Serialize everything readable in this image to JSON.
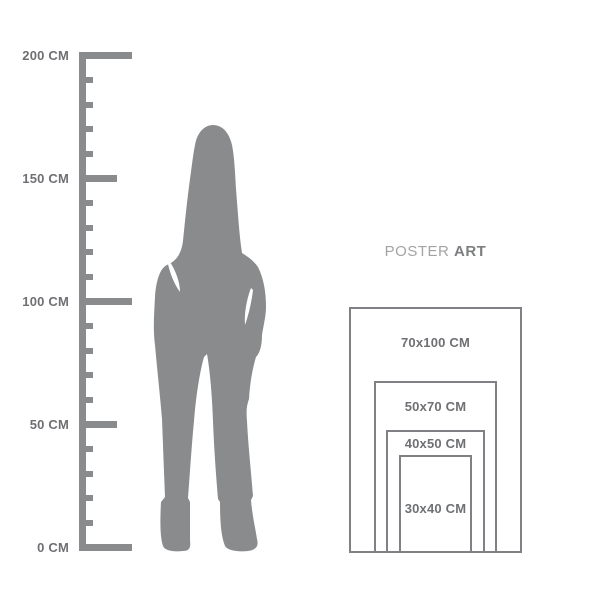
{
  "page": {
    "background": "#ffffff"
  },
  "ruler": {
    "unit": "CM",
    "max_cm": 200,
    "minor_tick_interval_cm": 10,
    "color": "#8a8b8d",
    "label_color": "#6f7073",
    "labels": [
      {
        "text": "200 CM",
        "cm": 200
      },
      {
        "text": "150 CM",
        "cm": 150
      },
      {
        "text": "100 CM",
        "cm": 100
      },
      {
        "text": "50 CM",
        "cm": 50
      },
      {
        "text": "0 CM",
        "cm": 0
      }
    ]
  },
  "figure": {
    "kind": "standing-woman-silhouette",
    "color": "#8a8b8d"
  },
  "poster_group": {
    "title": {
      "regular": "POSTER",
      "bold": "ART"
    },
    "title_color_regular": "#a3a4a6",
    "title_color_bold": "#7c7e80",
    "border_color": "#808184",
    "label_color": "#6f7073",
    "sizes": [
      {
        "label": "70x100 CM",
        "w_cm": 70,
        "h_cm": 100
      },
      {
        "label": "50x70 CM",
        "w_cm": 50,
        "h_cm": 70
      },
      {
        "label": "40x50 CM",
        "w_cm": 40,
        "h_cm": 50
      },
      {
        "label": "30x40 CM",
        "w_cm": 30,
        "h_cm": 40
      }
    ]
  }
}
